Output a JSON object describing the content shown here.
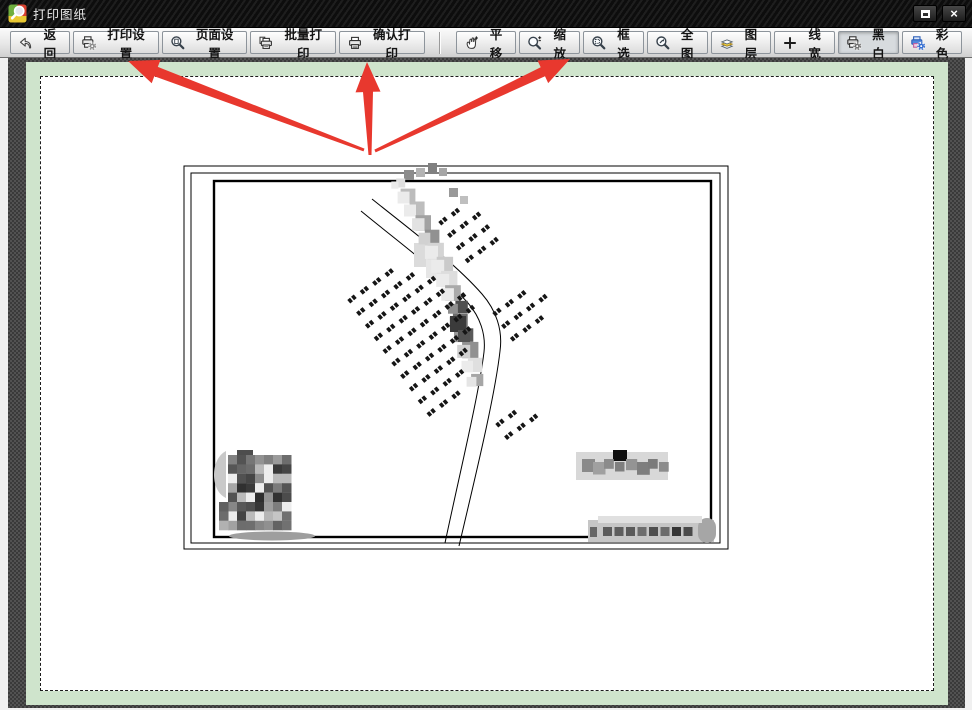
{
  "window": {
    "title": "打印图纸",
    "close_glyph": "×"
  },
  "toolbar": {
    "buttons": [
      {
        "id": "back",
        "label": "返回",
        "icon": "back-arrow-icon"
      },
      {
        "id": "print-settings",
        "label": "打印设置",
        "icon": "printer-gear-icon"
      },
      {
        "id": "page-setup",
        "label": "页面设置",
        "icon": "magnifier-page-icon"
      },
      {
        "id": "batch-print",
        "label": "批量打印",
        "icon": "printer-stack-icon"
      },
      {
        "id": "confirm-print",
        "label": "确认打印",
        "icon": "printer-icon"
      },
      {
        "id": "pan",
        "label": "平移",
        "icon": "hand-pan-icon"
      },
      {
        "id": "zoom",
        "label": "缩放",
        "icon": "magnifier-plusminus-icon"
      },
      {
        "id": "box-select",
        "label": "框选",
        "icon": "magnifier-box-icon"
      },
      {
        "id": "full-view",
        "label": "全图",
        "icon": "magnifier-arrow-icon"
      },
      {
        "id": "layers",
        "label": "图层",
        "icon": "layers-icon"
      },
      {
        "id": "line-width",
        "label": "线宽",
        "icon": "crosshair-icon"
      },
      {
        "id": "black-white",
        "label": "黑白",
        "icon": "printer-bw-icon",
        "active": true
      },
      {
        "id": "color",
        "label": "彩色",
        "icon": "printer-color-icon"
      }
    ]
  },
  "preview": {
    "paper_margin_color": "#cfe4cc",
    "page_background": "#ffffff",
    "content_description": "black-and-white site plan drawing with censored (pixelated) text labels"
  },
  "annotations": {
    "color": "#e8382e",
    "arrows": [
      {
        "points_to": "print-settings",
        "tail": [
          364,
          150
        ],
        "tip": [
          128,
          61
        ]
      },
      {
        "points_to": "confirm-print",
        "tail": [
          370,
          155
        ],
        "tip": [
          367,
          62
        ]
      },
      {
        "points_to": "box-select",
        "tail": [
          375,
          151
        ],
        "tip": [
          570,
          59
        ]
      }
    ]
  }
}
